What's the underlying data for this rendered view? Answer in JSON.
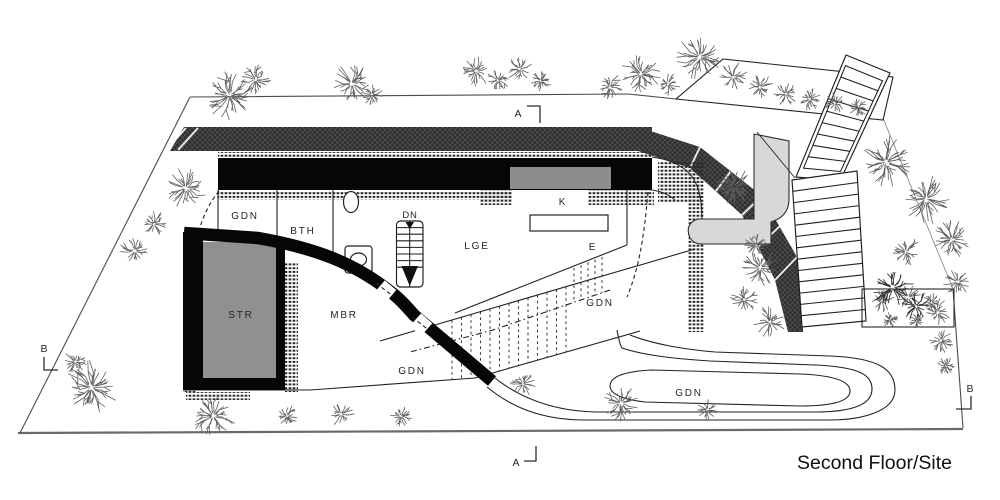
{
  "drawing": {
    "title": "Second Floor/Site",
    "room_labels": [
      {
        "id": "gdn-upper",
        "text": "GDN"
      },
      {
        "id": "bth",
        "text": "BTH"
      },
      {
        "id": "dn",
        "text": "DN"
      },
      {
        "id": "lge",
        "text": "LGE"
      },
      {
        "id": "k",
        "text": "K"
      },
      {
        "id": "e",
        "text": "E"
      },
      {
        "id": "str",
        "text": "STR"
      },
      {
        "id": "mbr",
        "text": "MBR"
      },
      {
        "id": "gdn-mid",
        "text": "GDN"
      },
      {
        "id": "gdn-lower",
        "text": "GDN"
      },
      {
        "id": "gdn-drive",
        "text": "GDN"
      }
    ],
    "section_markers": [
      {
        "id": "a-top",
        "text": "A"
      },
      {
        "id": "a-bottom",
        "text": "A"
      },
      {
        "id": "b-left",
        "text": "B"
      },
      {
        "id": "b-right",
        "text": "B"
      }
    ],
    "colors": {
      "ink": "#222222",
      "wall": "#060606",
      "hatchbg": "#2f2f2f",
      "hatchlight": "#8a8a8a",
      "tick": "#2b2b2b",
      "roomgray": "#909090",
      "windowgray": "#8d8d8d",
      "pathgray": "#d8d8d8",
      "foliage": "#606060",
      "foliagedark": "#333333",
      "label": "#262626"
    }
  }
}
